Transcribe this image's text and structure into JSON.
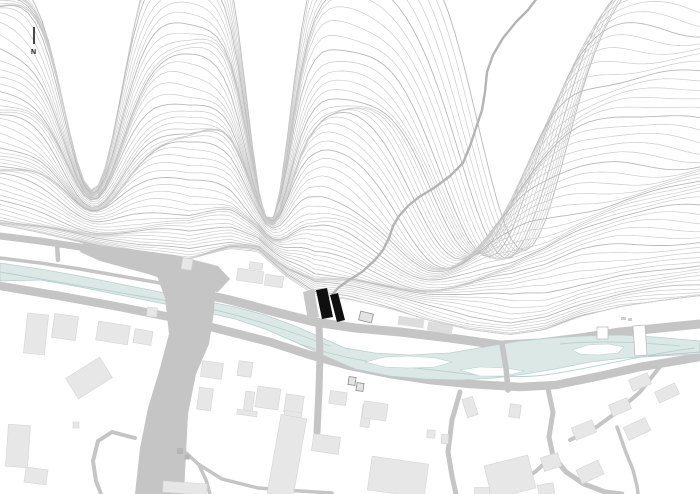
{
  "map": {
    "north_label": "N",
    "colors": {
      "background": "#ffffff",
      "contour": "#cdcdcd",
      "contour_index": "#b9b9b9",
      "trail": "#b4b4b4",
      "road": "#c5c5c5",
      "river_fill": "#dbe8e6",
      "river_edge": "#b8d1ce",
      "building": "#e7e7e7",
      "building_edge": "#d8d8d8",
      "building_dark": "#dddddd",
      "building_mid": "#b5b5b5",
      "building_outline": "#8f8f8f",
      "site_gray": "#c7c7c7",
      "site_black": "#0f0f0f",
      "structure": "#bdbdbd",
      "north_arrow": "#1a1a1a"
    }
  }
}
